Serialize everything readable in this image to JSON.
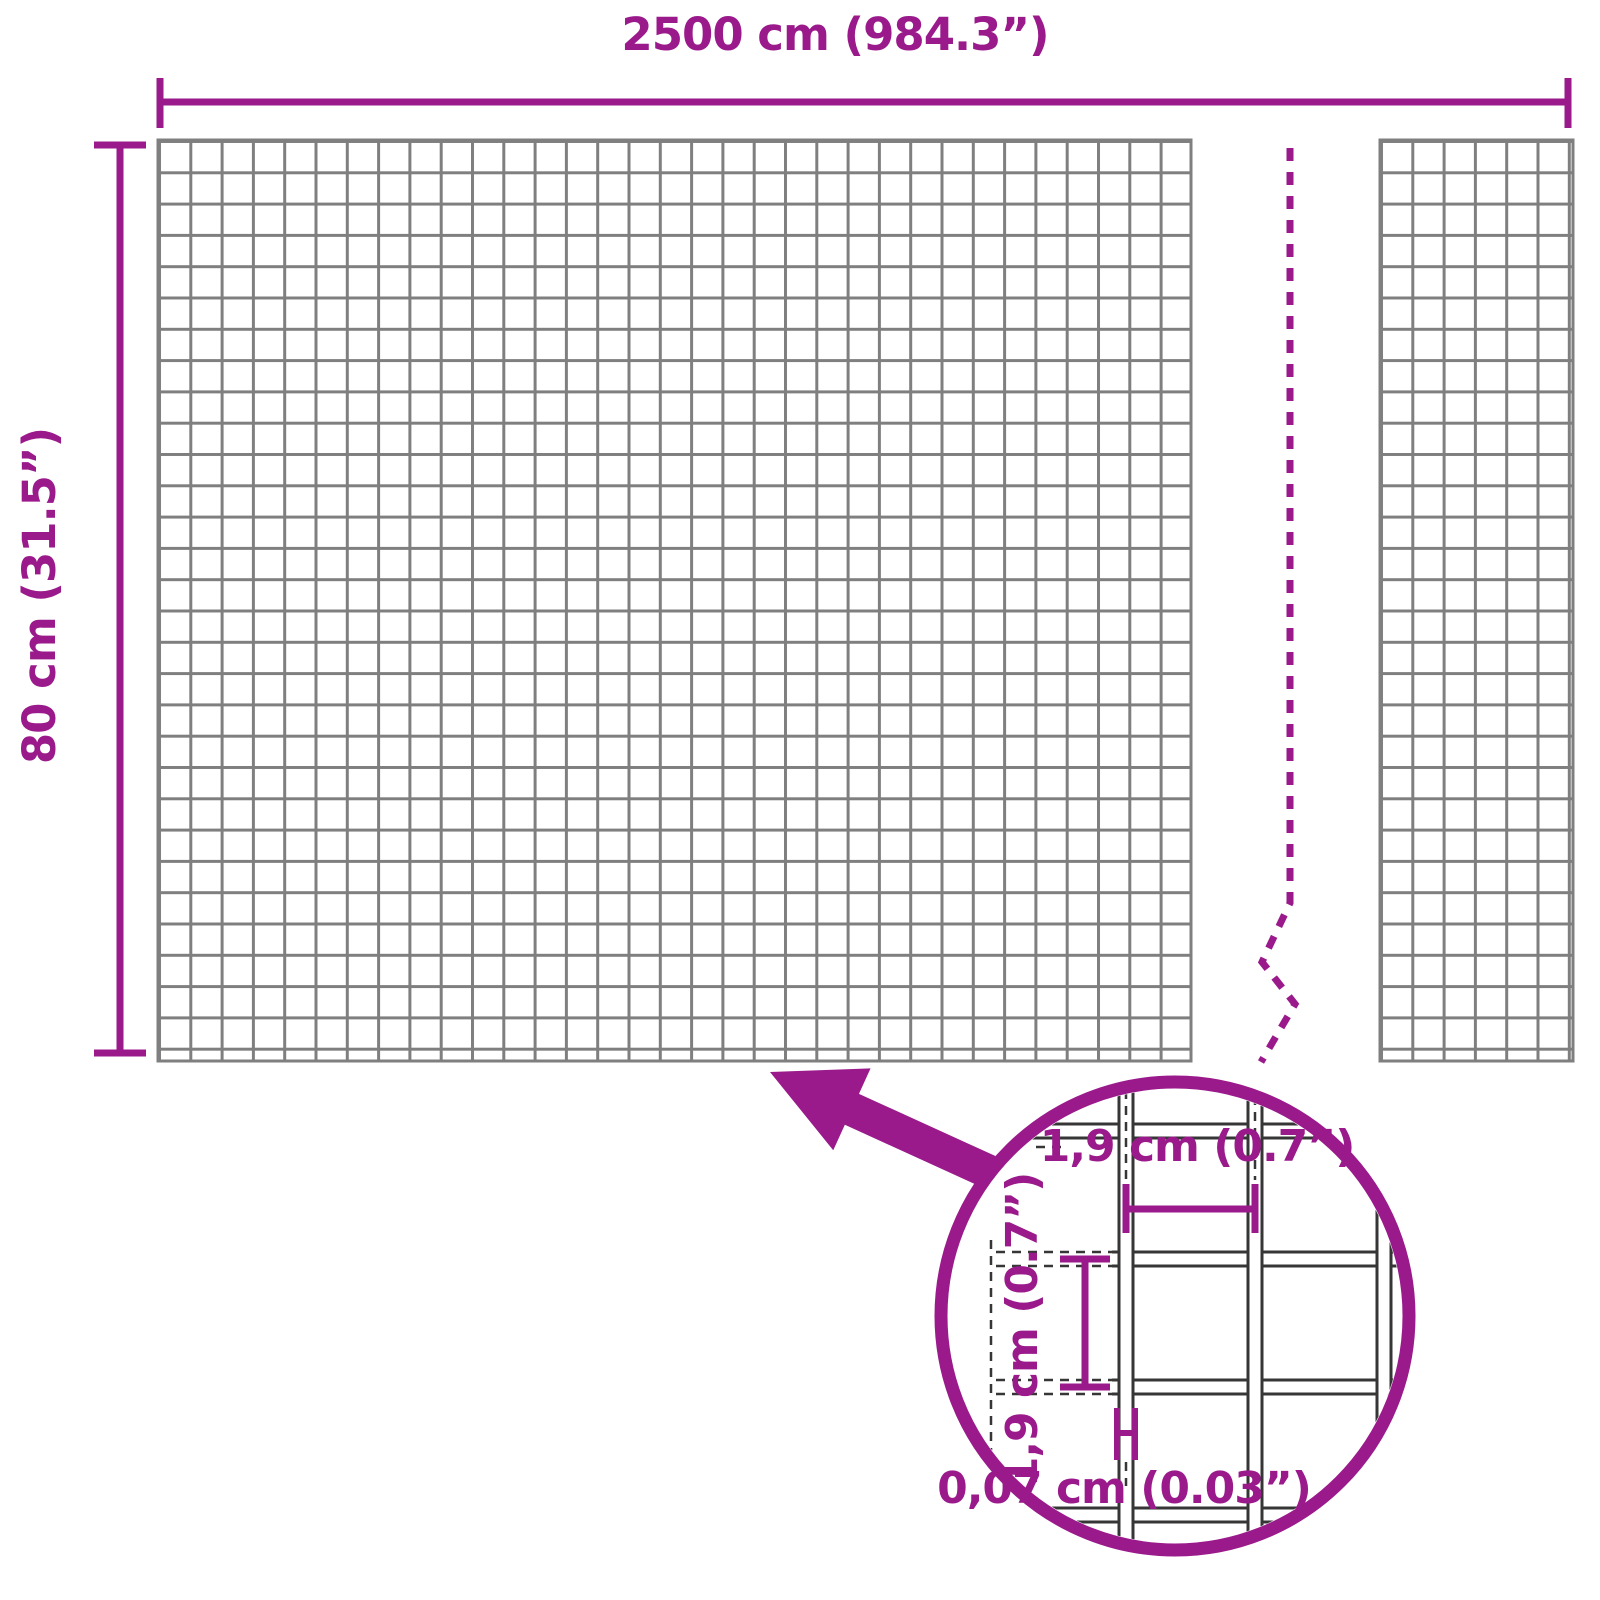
{
  "diagram": {
    "overall": {
      "width_label": "2500 cm (984.3”)",
      "height_label": "80 cm (31.5”)"
    },
    "magnifier": {
      "mesh_width_label": "1,9 cm (0.7”)",
      "mesh_height_label": "1,9 cm (0.7”)",
      "wire_thickness_label": "0,07 cm (0.03”)"
    }
  },
  "colors": {
    "accent": "#9A1A8B",
    "mesh_line": "#7F7F7F",
    "detail_line": "#363636",
    "background": "#FFFFFF"
  }
}
